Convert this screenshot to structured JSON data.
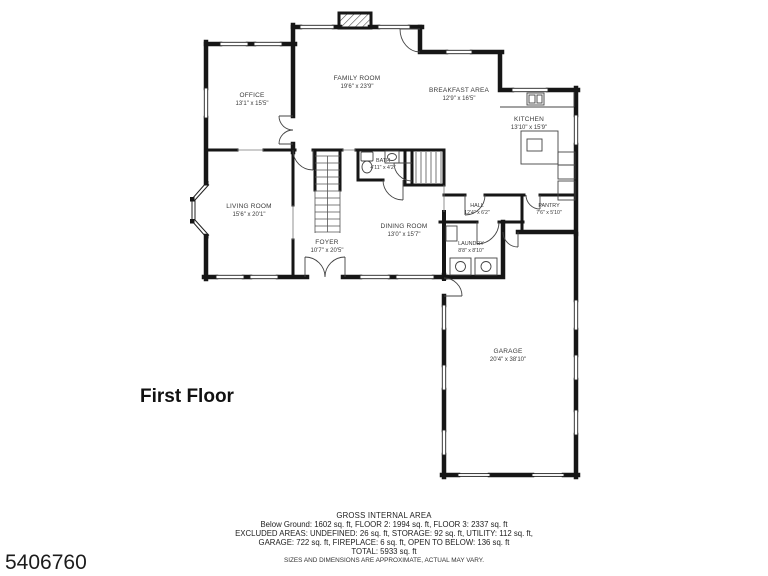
{
  "page": {
    "photo_id": "5406760",
    "floor_label": "First Floor"
  },
  "rooms": {
    "office": {
      "name": "OFFICE",
      "dims": "13'1\" x 15'5\""
    },
    "family": {
      "name": "FAMILY ROOM",
      "dims": "19'6\" x 23'9\""
    },
    "breakfast": {
      "name": "BREAKFAST AREA",
      "dims": "12'9\" x 16'5\""
    },
    "kitchen": {
      "name": "KITCHEN",
      "dims": "13'10\" x 15'9\""
    },
    "living": {
      "name": "LIVING ROOM",
      "dims": "15'6\" x 20'1\""
    },
    "foyer": {
      "name": "FOYER",
      "dims": "10'7\" x 20'5\""
    },
    "dining": {
      "name": "DINING ROOM",
      "dims": "13'0\" x 15'7\""
    },
    "bath": {
      "name": "BATH",
      "dims": "4'11\" x 4'2\""
    },
    "hall": {
      "name": "HALL",
      "dims": "12'4\" x 6'2\""
    },
    "pantry": {
      "name": "PANTRY",
      "dims": "7'6\" x 5'10\""
    },
    "laundry": {
      "name": "LAUNDRY",
      "dims": "8'8\" x 8'10\""
    },
    "garage": {
      "name": "GARAGE",
      "dims": "20'4\" x 38'10\""
    }
  },
  "footer": {
    "title": "GROSS INTERNAL AREA",
    "line1": "Below Ground: 1602 sq. ft, FLOOR 2: 1994 sq. ft, FLOOR 3: 2337 sq. ft",
    "line2": "EXCLUDED AREAS: UNDEFINED: 26 sq. ft, STORAGE: 92 sq. ft, UTILITY: 112 sq. ft,",
    "line3": "GARAGE: 722 sq. ft, FIREPLACE: 6 sq. ft, OPEN TO BELOW: 136 sq. ft",
    "line4": "TOTAL: 5933 sq. ft",
    "disclaimer": "SIZES AND DIMENSIONS ARE APPROXIMATE, ACTUAL MAY VARY."
  }
}
